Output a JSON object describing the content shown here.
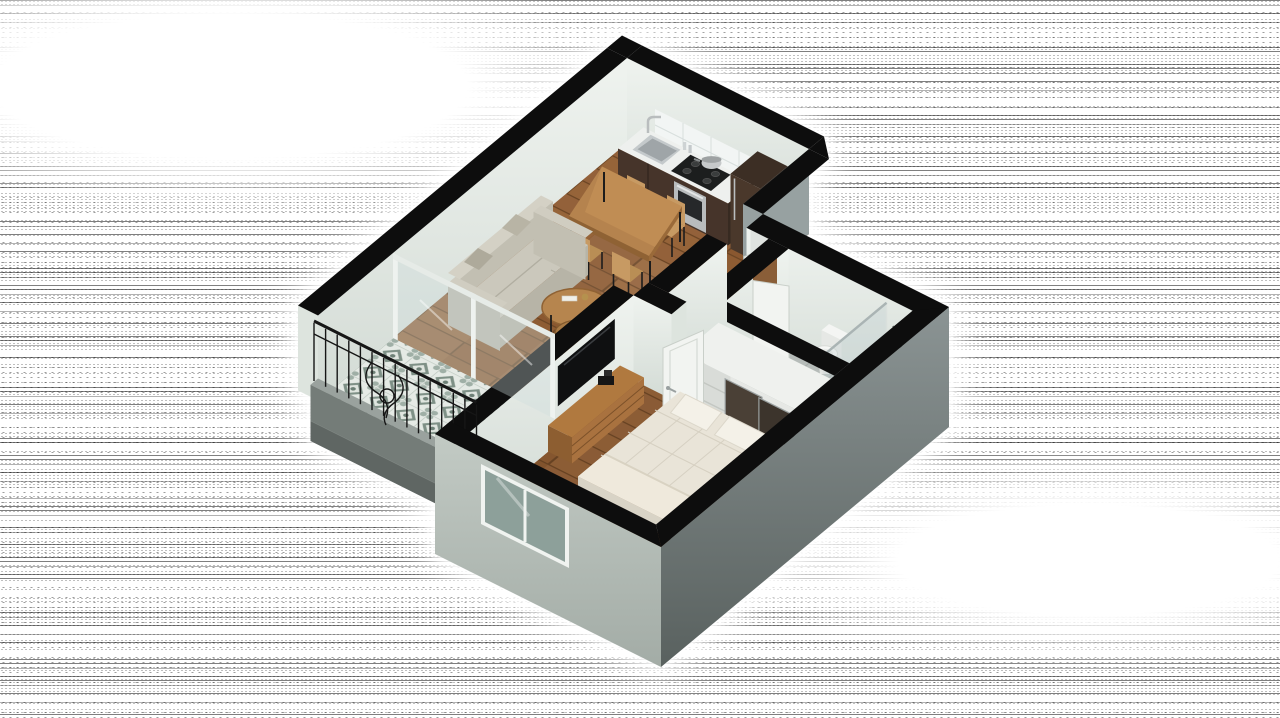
{
  "scene": {
    "type": "3d-isometric-floor-plan-render",
    "description": "Photorealistic 3D isometric cutaway floor plan of a one-bedroom apartment: open kitchen-dining-living room, long tiled balcony with wrought-iron railing, bedroom with double bed, TV console and built-in closet, and a bathroom with toilet, bidet and glass shower, rendered on a monochrome halftone-noise background",
    "projection": "dimetric top-down cutaway",
    "wall_style": "cut walls capped in black"
  },
  "background": {
    "pattern": "halftone-dither-noise-horizontal-bands",
    "ink": "#111111",
    "paper": "#ffffff",
    "halo": "white glow surrounding the building"
  },
  "palette": {
    "wall_cap": "#0d0d0d",
    "wall_interior": "#ebefec",
    "wall_interior_shade": "#ccd5cf",
    "wall_exterior_se": "#76807f",
    "wall_exterior_sw": "#b6bfb9",
    "wall_return_gray": "#97a1a1",
    "wood_floor": "#8e5c33",
    "wood_seam": "#6b4524",
    "balcony_tile_base": "#e5eae5",
    "balcony_tile_accent": "#7e9086",
    "bath_tile": "#b6bcb9",
    "counter_wood": "#46342a",
    "fridge_wood": "#4a382b",
    "sofa_fabric": "#cbc8bc",
    "mattress": "#e9e4d8",
    "table_wood": "#b5834e",
    "chair_wood": "#c79a63",
    "closet_door_dark": "#4a4036",
    "iron_railing": "#161616",
    "stainless": "#b9bdbe",
    "glass": "#cdd8d8"
  },
  "rooms": [
    {
      "name": "kitchen-dining",
      "floor": "wood planks",
      "items": [
        "kitchen counter",
        "stainless sink",
        "faucet",
        "gas cooktop",
        "pot",
        "built-in oven",
        "refrigerator column",
        "white tile backsplash",
        "dining table",
        "four wood chairs"
      ]
    },
    {
      "name": "living-room",
      "floor": "wood planks",
      "items": [
        "three-seat sofa",
        "two throw pillows",
        "two round nesting coffee tables",
        "table decor",
        "sliding glass balcony door"
      ]
    },
    {
      "name": "balcony",
      "floor": "patterned cement tiles",
      "items": [
        "concrete curb",
        "wrought-iron railing",
        "scroll ornament"
      ]
    },
    {
      "name": "hallway-entry",
      "floor": "wood planks",
      "items": [
        "entry door",
        "bathroom door",
        "bedroom door"
      ]
    },
    {
      "name": "bathroom",
      "floor": "gray ceramic tiles",
      "items": [
        "toilet",
        "bidet",
        "glass shower screen",
        "shower head"
      ]
    },
    {
      "name": "bedroom",
      "floor": "wood planks",
      "items": [
        "double bed with quilted mattress",
        "two pillows",
        "folded blanket",
        "cat",
        "tv console",
        "wall tv",
        "built-in closet with shelves and drawers",
        "two dark sliding closet doors",
        "potted plant",
        "low window wall"
      ]
    }
  ]
}
